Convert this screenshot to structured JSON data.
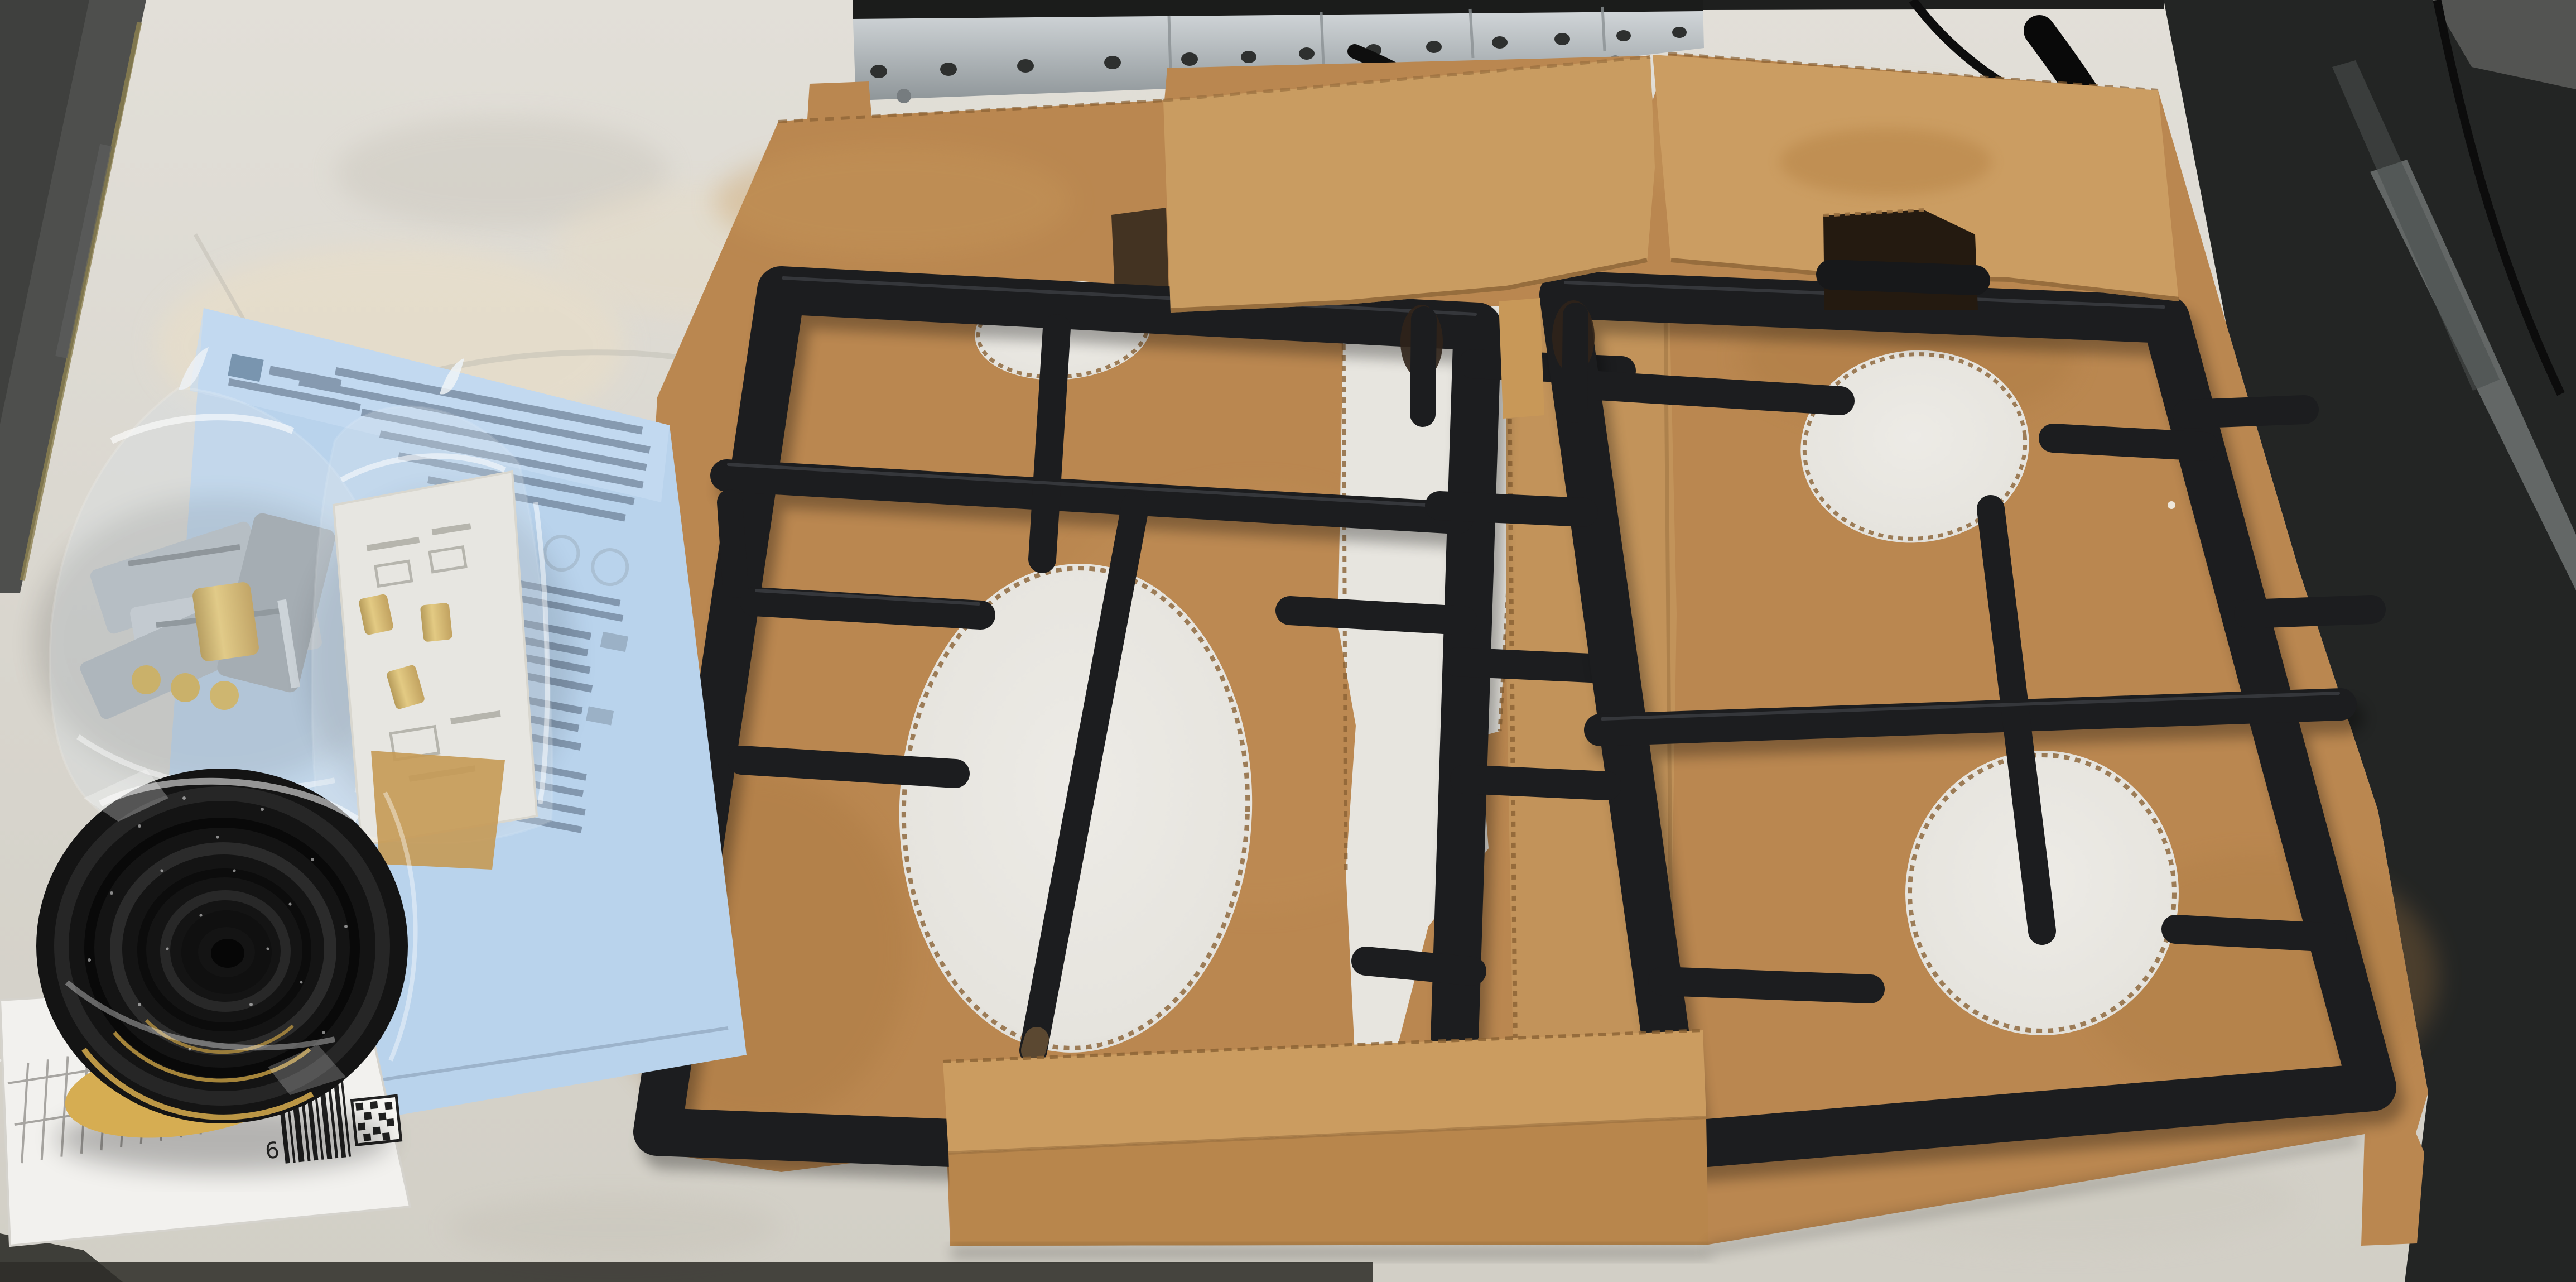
{
  "scene": {
    "type": "photograph",
    "subject": "gas-hob-shipping-package-with-cast-iron-pan-supports",
    "label": {
      "digit": "6"
    },
    "objects": {
      "pan_supports": "two black cast-iron grates on cardboard insert",
      "cardboard": "die-cut shipping tray with four burner holes",
      "accessories": "hardware bag, brass nozzle bag, foam sealing tape roll, instruction sheet"
    },
    "colors": {
      "table": "#dcd9d1",
      "cardboard": "#ba8750",
      "cardboard_light": "#cb9c60",
      "grate_black": "#1c1d1f",
      "sheet_blue": "#b9d3ec",
      "foam_black": "#141414",
      "foam_backing_yellow": "#d4ab52",
      "brass": "#c8992f",
      "metal_rail": "#aab0b3",
      "dark_background": "#232524"
    }
  }
}
